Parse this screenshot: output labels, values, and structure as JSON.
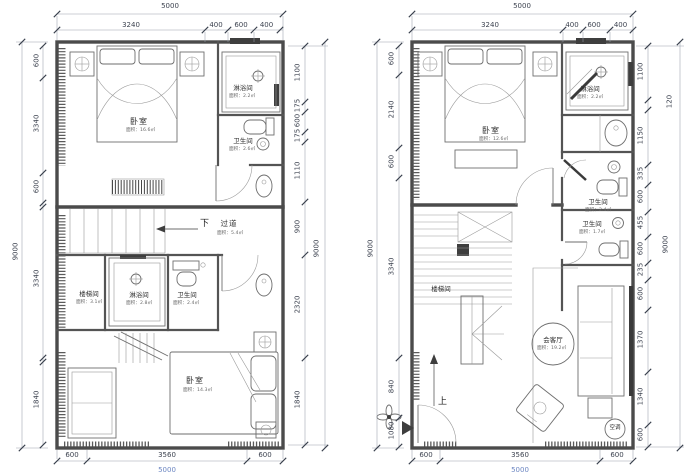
{
  "sheet": {
    "type": "floor plan drawing",
    "units": "mm"
  },
  "plans": [
    {
      "name": "upper-floor-plan",
      "dims_top": {
        "overall": "5000",
        "segments": [
          "3240",
          "400",
          "600",
          "400"
        ]
      },
      "dims_left": {
        "overall": "9000",
        "segments": [
          "600",
          "3340",
          "600",
          "3340",
          "1840"
        ]
      },
      "dims_right": {
        "overall": "9000",
        "segments": [
          "1100",
          "175",
          "600",
          "175",
          "1110",
          "900",
          "2320",
          "1840"
        ]
      },
      "dims_bottom": {
        "overall": "5000",
        "segments": [
          "600",
          "3560",
          "600"
        ]
      },
      "labels": {
        "bedroom_top": {
          "name": "卧室",
          "area": "面积：16.6㎡"
        },
        "shower_top": {
          "name": "淋浴间",
          "area": "面积：2.2㎡"
        },
        "bath_top": {
          "name": "卫生间",
          "area": "面积：2.6㎡"
        },
        "down": "下",
        "corridor": {
          "name": "过道",
          "area": "面积：5.4㎡"
        },
        "stairwell": {
          "name": "楼梯间",
          "area": "面积：3.1㎡"
        },
        "shower_mid": {
          "name": "淋浴间",
          "area": "面积：2.8㎡"
        },
        "bath_mid": {
          "name": "卫生间",
          "area": "面积：2.4㎡"
        },
        "bedroom_bottom": {
          "name": "卧室",
          "area": "面积：14.3㎡"
        }
      }
    },
    {
      "name": "lower-floor-plan",
      "dims_top": {
        "overall": "5000",
        "segments": [
          "3240",
          "400",
          "600",
          "400"
        ]
      },
      "dims_left": {
        "overall": "9000",
        "segments": [
          "600",
          "2140",
          "600",
          "3340",
          "840",
          "1080"
        ]
      },
      "dims_right": {
        "overall": "9000",
        "segments": [
          "1100",
          "120",
          "1150",
          "335",
          "600",
          "455",
          "600",
          "235",
          "600",
          "1370",
          "1340",
          "600"
        ]
      },
      "dims_bottom": {
        "overall": "5000",
        "segments": [
          "600",
          "3560",
          "600"
        ]
      },
      "labels": {
        "bedroom": {
          "name": "卧室",
          "area": "面积：12.6㎡"
        },
        "shower": {
          "name": "淋浴间",
          "area": "面积：2.2㎡"
        },
        "bath_upper": {
          "name": "卫生间",
          "area": "面积：2.4㎡"
        },
        "bath_lower": {
          "name": "卫生间",
          "area": "面积：1.7㎡"
        },
        "stairwell": {
          "name": "楼梯间"
        },
        "living": {
          "name": "会客厅",
          "area": "面积：19.2㎡"
        },
        "up": "上",
        "ac": "空调"
      }
    }
  ]
}
